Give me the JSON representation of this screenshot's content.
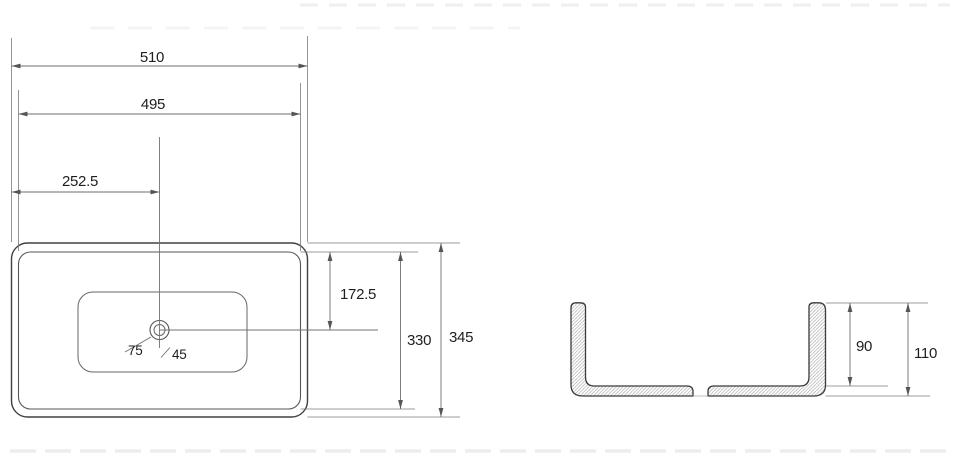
{
  "top_view": {
    "overall_width": "510",
    "inner_width": "495",
    "center_offset": "252.5",
    "center_from_top": "172.5",
    "inner_depth": "330",
    "overall_depth": "345",
    "drain_outer_diameter": "75",
    "drain_inner_diameter": "45"
  },
  "side_view": {
    "inner_height": "90",
    "overall_height": "110"
  },
  "colors": {
    "background": "#ffffff",
    "outline": "#404040",
    "dimension_line": "#6e6e6e",
    "text": "#1f1f1f",
    "hatch": "#989898"
  }
}
